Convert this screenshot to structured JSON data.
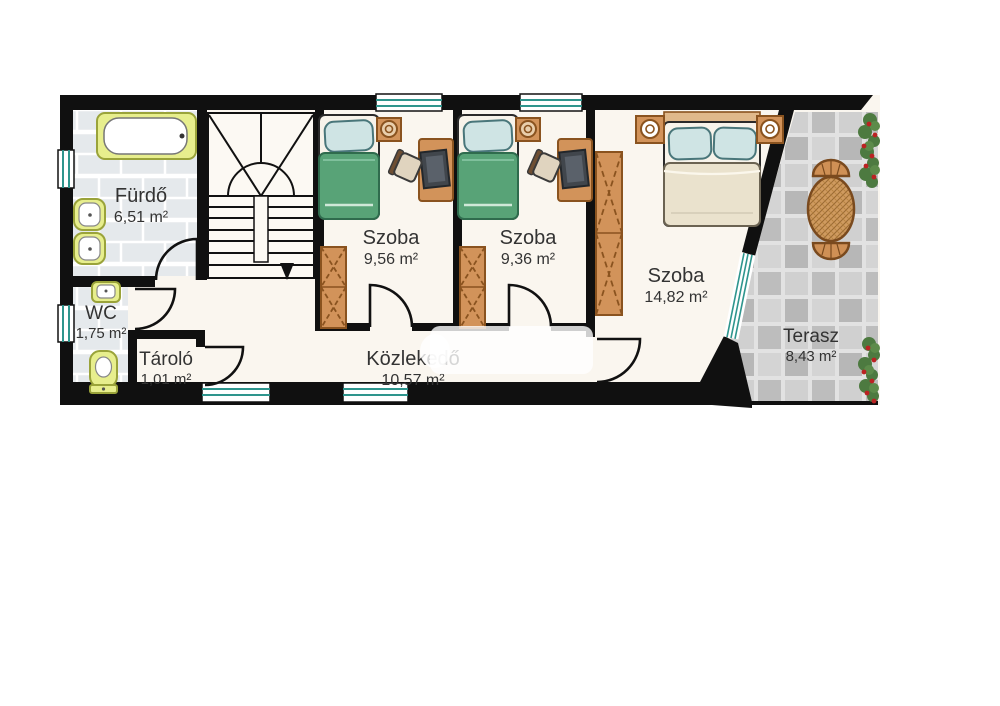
{
  "rooms": [
    {
      "id": "furdo",
      "name": "Fürdő",
      "area": "6,51 m²"
    },
    {
      "id": "wc",
      "name": "WC",
      "area": "1,75 m²"
    },
    {
      "id": "tarolo",
      "name": "Tároló",
      "area": "1,01 m²"
    },
    {
      "id": "szoba1",
      "name": "Szoba",
      "area": "9,56 m²"
    },
    {
      "id": "szoba2",
      "name": "Szoba",
      "area": "9,36 m²"
    },
    {
      "id": "szoba3",
      "name": "Szoba",
      "area": "14,82 m²"
    },
    {
      "id": "kozlekedo",
      "name": "Közlekedő",
      "area": "10,57 m²"
    },
    {
      "id": "terasz",
      "name": "Terasz",
      "area": "8,43 m²"
    }
  ],
  "fixtures": [
    "bathtub-icon",
    "bath-sink-icon",
    "wc-sink-icon",
    "toilet-icon",
    "staircase-icon",
    "single-bed-icon",
    "double-bed-icon",
    "nightstand-icon",
    "lamp-icon",
    "desk-icon",
    "office-chair-icon",
    "monitor-icon",
    "wardrobe-icon",
    "terrace-table-icon",
    "terrace-chair-icon",
    "flower-box-icon",
    "window-icon",
    "door-icon"
  ],
  "colors": {
    "wall": "#101010",
    "floor": "#faf6ef",
    "tile": "#e5e9ec",
    "stone": "#c6c6c6",
    "wood": "#d2935a",
    "wood_border": "#8a531f",
    "bed_green": "#58a377",
    "pillow_blue": "#cfe4e4",
    "sanitary_yellow": "#e7ee8d",
    "window_teal": "#2e958d",
    "label": "#333333",
    "flower_green": "#4d7a40",
    "flower_red": "#bb2222"
  }
}
